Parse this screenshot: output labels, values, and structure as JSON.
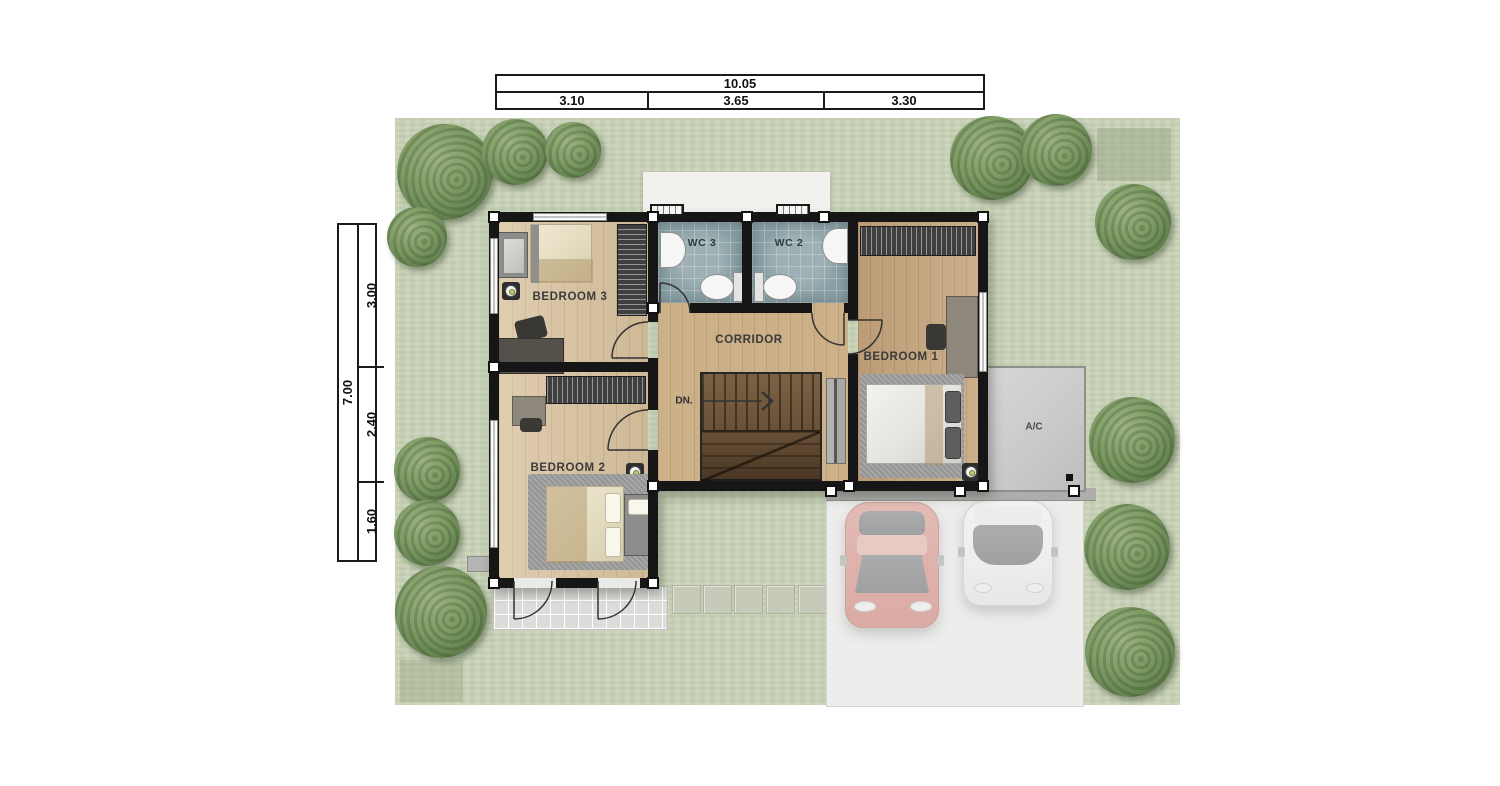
{
  "floor_plan": {
    "room_labels": {
      "bedroom1": "BEDROOM 1",
      "bedroom2": "BEDROOM 2",
      "bedroom3": "BEDROOM 3",
      "wc2": "WC 2",
      "wc3": "WC 3",
      "corridor": "CORRIDOR",
      "stairs_down": "DN.",
      "ac": "A/C"
    },
    "dim_top": {
      "total": "10.05",
      "seg1": "3.10",
      "seg2": "3.65",
      "seg3": "3.30"
    },
    "dim_left": {
      "total": "7.00",
      "seg1": "3.00",
      "seg2": "2.40",
      "seg3": "1.60"
    },
    "colors": {
      "lawn": "#c9d3b8",
      "tree": "#6f8a58",
      "wall": "#161616",
      "wood_light": "#d9c29e",
      "wood_mid": "#ccb088",
      "wood_dark": "#c7a67e",
      "wc_tile": "#8ba1a6",
      "stairs": "#6a5138",
      "terrace": "#dcdcda",
      "garage_pad": "#ededec",
      "carport_beam": "#aeadab",
      "ac_pad": "#cdcdcd",
      "car_red": "#cf7165",
      "car_white": "#f4f4f3",
      "porch": "#f2f1ee"
    }
  }
}
